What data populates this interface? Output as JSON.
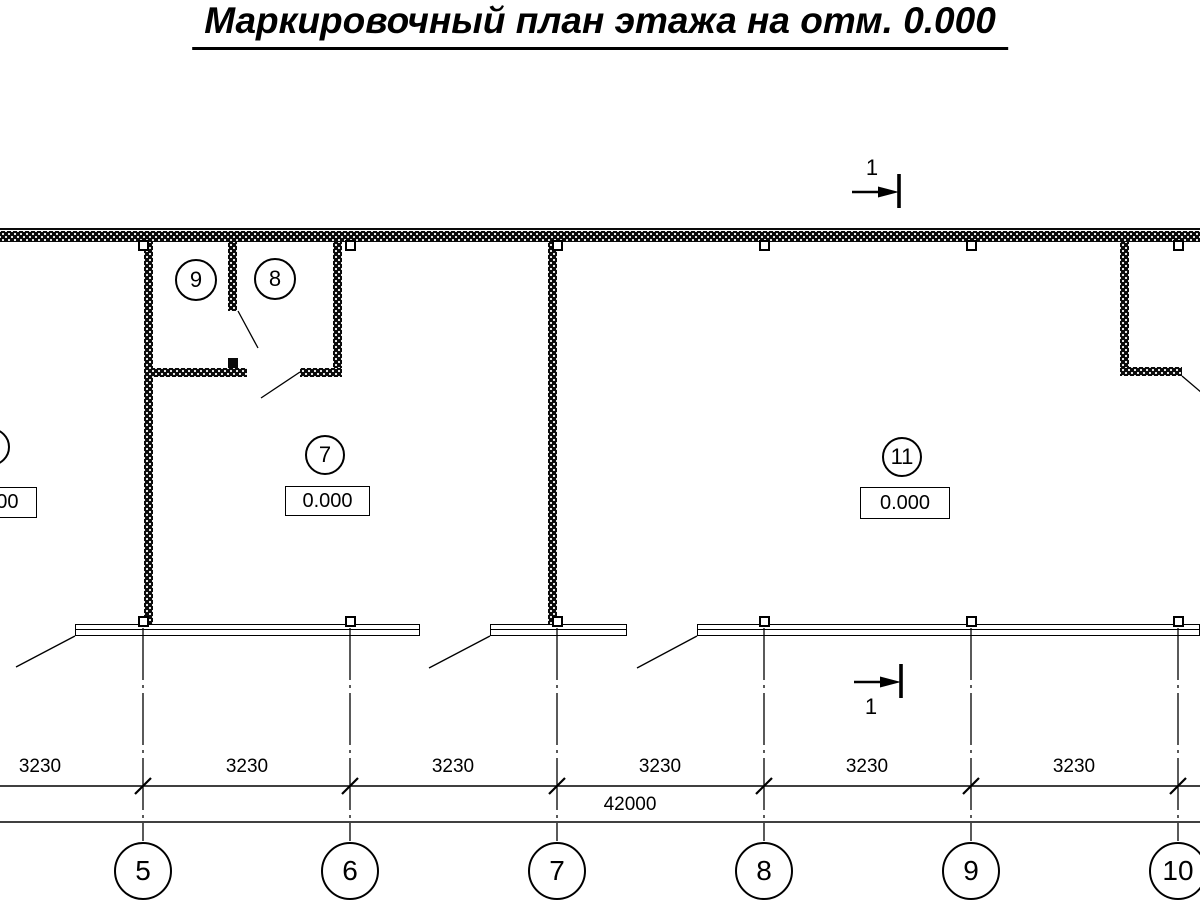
{
  "title": "Маркировочный план этажа на отм. 0.000",
  "section_mark": {
    "top_label": "1",
    "bottom_label": "1"
  },
  "rooms": {
    "left_partial": {
      "elevation": "0.000"
    },
    "room9": {
      "number": "9"
    },
    "room8": {
      "number": "8"
    },
    "room7": {
      "number": "7",
      "elevation": "0.000"
    },
    "room11": {
      "number": "11",
      "elevation": "0.000"
    }
  },
  "dimensions": {
    "segments": [
      "3230",
      "3230",
      "3230",
      "3230",
      "3230",
      "3230"
    ],
    "total": "42000"
  },
  "axes": [
    "5",
    "6",
    "7",
    "8",
    "9",
    "10"
  ],
  "colors": {
    "ink": "#000000",
    "background": "#ffffff"
  }
}
